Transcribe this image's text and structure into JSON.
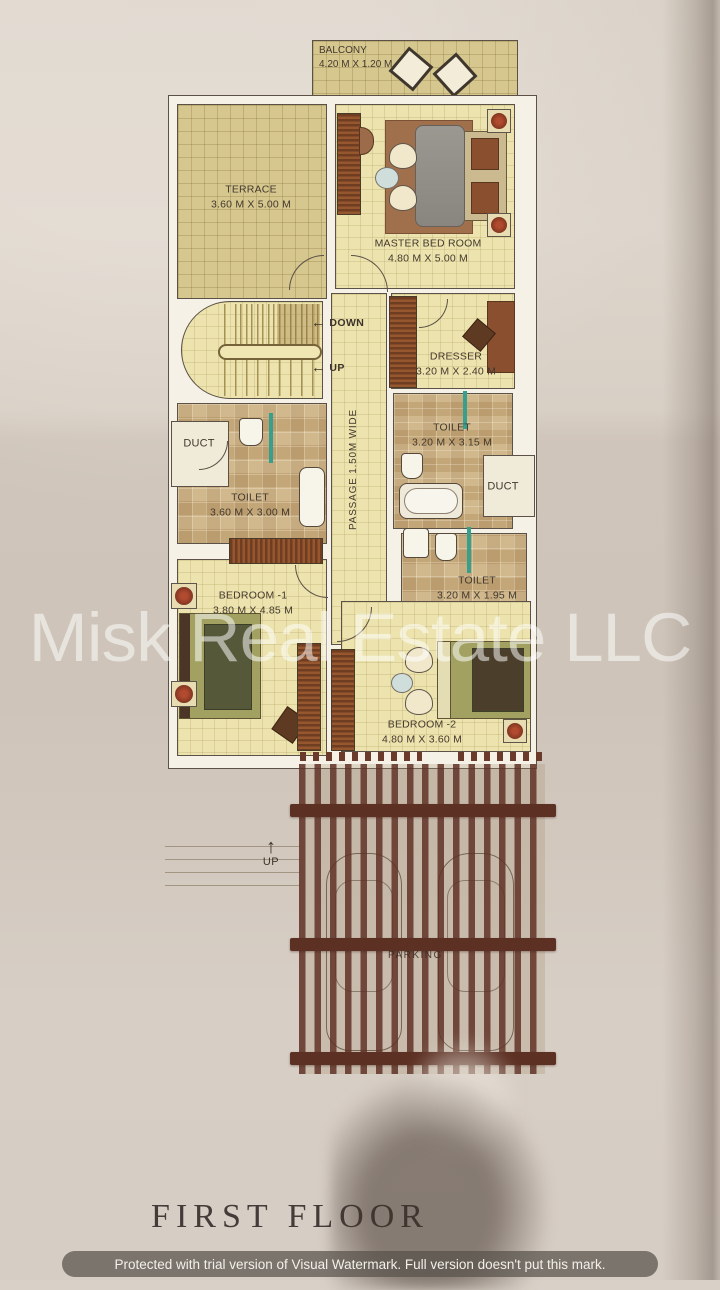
{
  "title": "FIRST FLOOR",
  "watermark": {
    "center": "Misk Real Estate LLC",
    "bottom_bar": "Protected with trial version of Visual Watermark. Full version doesn't put this mark."
  },
  "plan": {
    "balcony": {
      "name": "BALCONY",
      "dims": "4.20 M X 1.20 M"
    },
    "terrace": {
      "name": "TERRACE",
      "dims": "3.60 M X 5.00 M"
    },
    "master_bedroom": {
      "name": "MASTER BED ROOM",
      "dims": "4.80 M X 5.00 M"
    },
    "dresser": {
      "name": "DRESSER",
      "dims": "3.20 M X 2.40 M"
    },
    "toilet_master": {
      "name": "TOILET",
      "dims": "3.20 M X 3.15 M"
    },
    "toilet_left": {
      "name": "TOILET",
      "dims": "3.60 M X 3.00 M"
    },
    "toilet_small": {
      "name": "TOILET",
      "dims": "3.20 M X 1.95 M"
    },
    "bedroom_1": {
      "name": "BEDROOM -1",
      "dims": "3.80 M X 4.85 M"
    },
    "bedroom_2": {
      "name": "BEDROOM -2",
      "dims": "4.80 M X 3.60 M"
    },
    "duct_left": "DUCT",
    "duct_right": "DUCT",
    "passage": "PASSAGE 1.50M WIDE",
    "stairs": {
      "down": "DOWN",
      "up": "UP"
    },
    "exterior_stairs_up": "UP",
    "parking": "PARKING"
  },
  "icons": {
    "arrow_left": "←",
    "arrow_up": "↑"
  },
  "colors": {
    "wall_outline": "#5b5146",
    "wall_fill": "#f6f1e7",
    "floor_yellow": "#ece3ae",
    "floor_terrace": "#d6c78e",
    "floor_tile": "#ceb384",
    "wood": "#8a4f2e",
    "pergola": "#5c3023",
    "teal_fixture": "#37a08c",
    "paper": "#d5ccc2"
  }
}
